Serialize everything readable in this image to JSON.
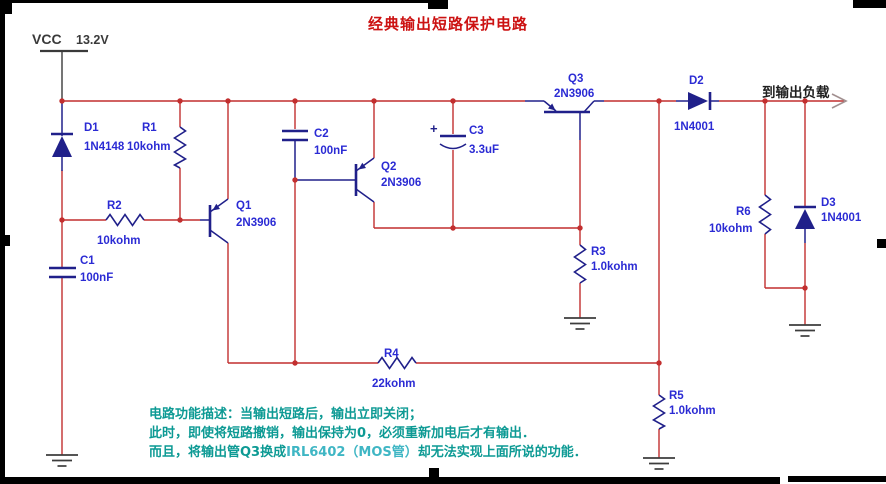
{
  "title": "经典输出短路保护电路",
  "power": {
    "label": "VCC",
    "voltage": "13.2V"
  },
  "output": {
    "label": "到输出负载"
  },
  "components": {
    "D1": {
      "ref": "D1",
      "value": "1N4148"
    },
    "R1": {
      "ref": "R1",
      "value": "10kohm"
    },
    "R2": {
      "ref": "R2",
      "value": "10kohm"
    },
    "C1": {
      "ref": "C1",
      "value": "100nF"
    },
    "Q1": {
      "ref": "Q1",
      "value": "2N3906"
    },
    "C2": {
      "ref": "C2",
      "value": "100nF"
    },
    "Q2": {
      "ref": "Q2",
      "value": "2N3906"
    },
    "C3": {
      "ref": "C3",
      "value": "3.3uF",
      "polarity": "+"
    },
    "Q3": {
      "ref": "Q3",
      "value": "2N3906"
    },
    "D2": {
      "ref": "D2",
      "value": "1N4001"
    },
    "R3": {
      "ref": "R3",
      "value": "1.0kohm"
    },
    "R4": {
      "ref": "R4",
      "value": "22kohm"
    },
    "R5": {
      "ref": "R5",
      "value": "1.0kohm"
    },
    "R6": {
      "ref": "R6",
      "value": "10kohm"
    },
    "D3": {
      "ref": "D3",
      "value": "1N4001"
    }
  },
  "description": {
    "line1": "电路功能描述：当输出短路后，输出立即关闭；",
    "line2": "此时，即使将短路撤销，输出保持为0，必须重新加电后才有输出．",
    "line3_prefix": "而且，将输出管Q3换成",
    "line3_highlight": "IRL6402（MOS管）",
    "line3_suffix": "却无法实现上面所说的功能．"
  },
  "colors": {
    "wire_red": "#c22f2f",
    "symbol_navy": "#20208a",
    "label_blue": "#2b2bd4",
    "title_red": "#cc1212",
    "desc_teal": "#0d9a94",
    "desc_highlight": "#3fb6c4",
    "ground_gray": "#3d3d3d",
    "vcc_gray": "#3a3a3a",
    "text_dark": "#1f1f1f",
    "output_arrow": "#a29090",
    "background": "#ffffff",
    "border_black": "#000000"
  }
}
